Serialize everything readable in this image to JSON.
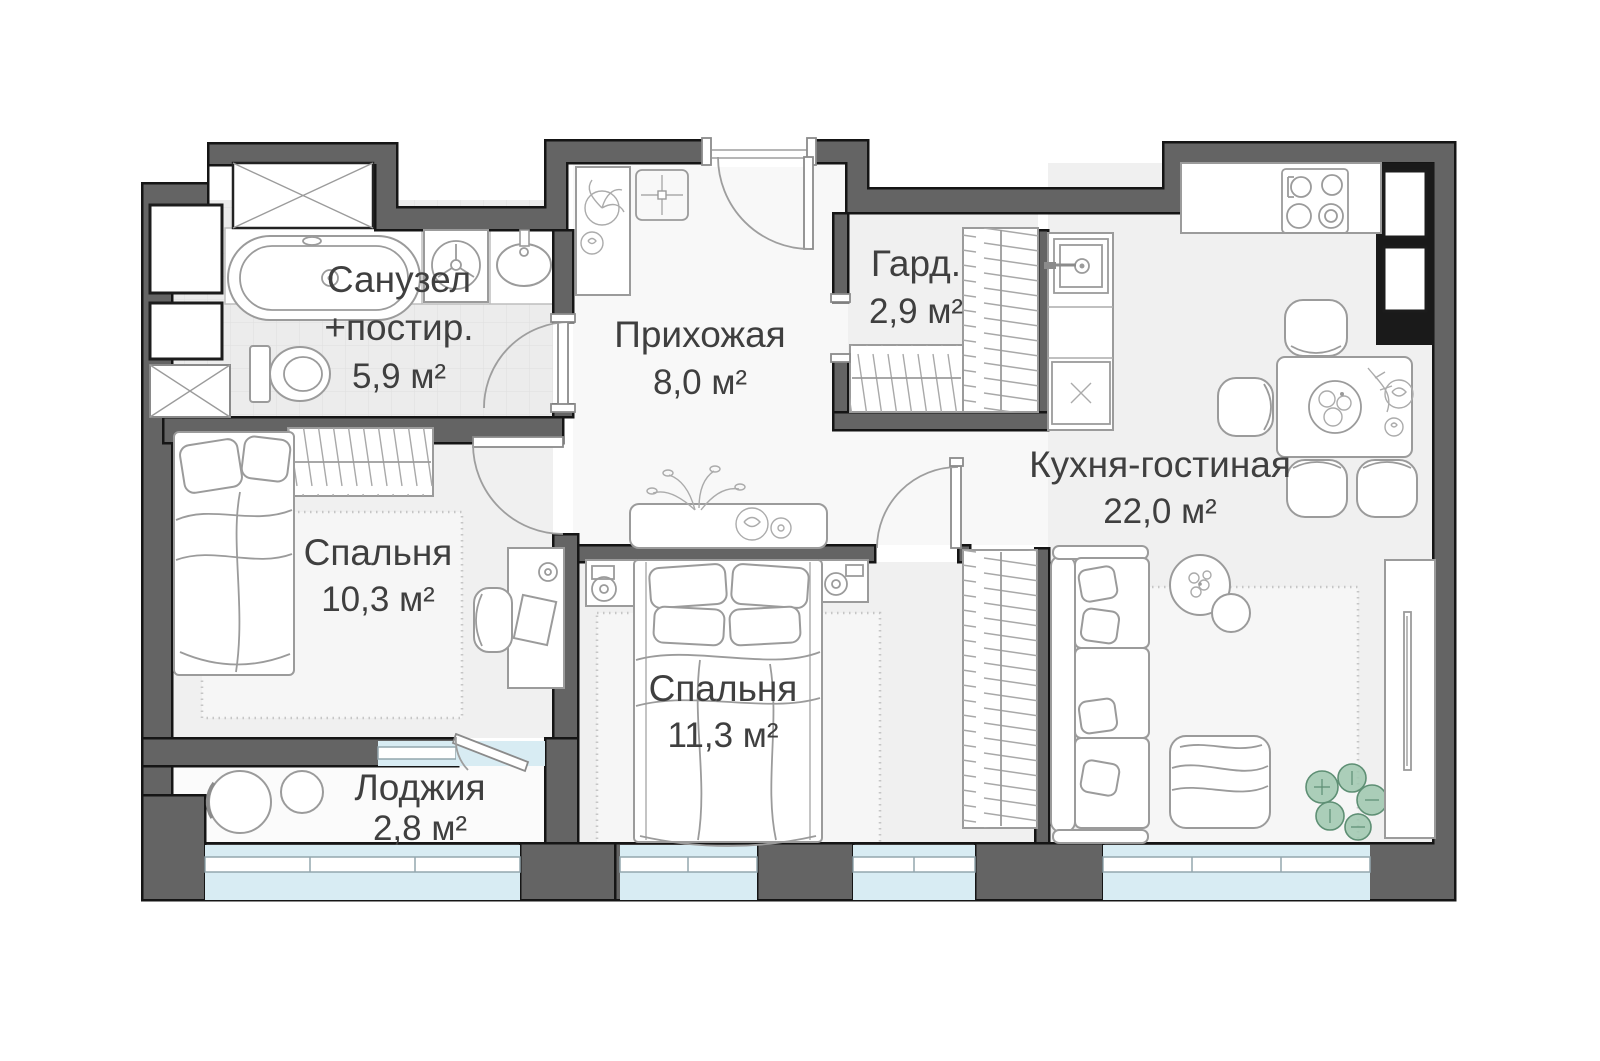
{
  "plan": {
    "rooms": {
      "bathroom": {
        "name_line1": "Санузел",
        "name_line2": "+постир.",
        "area": "5,9 м²"
      },
      "hallway": {
        "name": "Прихожая",
        "area": "8,0 м²"
      },
      "wardrobe": {
        "name": "Гард.",
        "area": "2,9 м²"
      },
      "kitchen_living": {
        "name": "Кухня-гостиная",
        "area": "22,0 м²"
      },
      "bedroom_1": {
        "name": "Спальня",
        "area": "10,3 м²"
      },
      "bedroom_2": {
        "name": "Спальня",
        "area": "11,3 м²"
      },
      "loggia": {
        "name": "Лоджия",
        "area": "2,8 м²"
      }
    },
    "colors": {
      "wall": "#646464",
      "wall_outline": "#151515",
      "glazing": "#d8ecf3",
      "floor": "#f0f0f0",
      "furniture_stroke": "#9b9b9b",
      "plant_green": "#8fbf9f",
      "label_text": "#3f3f3f"
    }
  }
}
